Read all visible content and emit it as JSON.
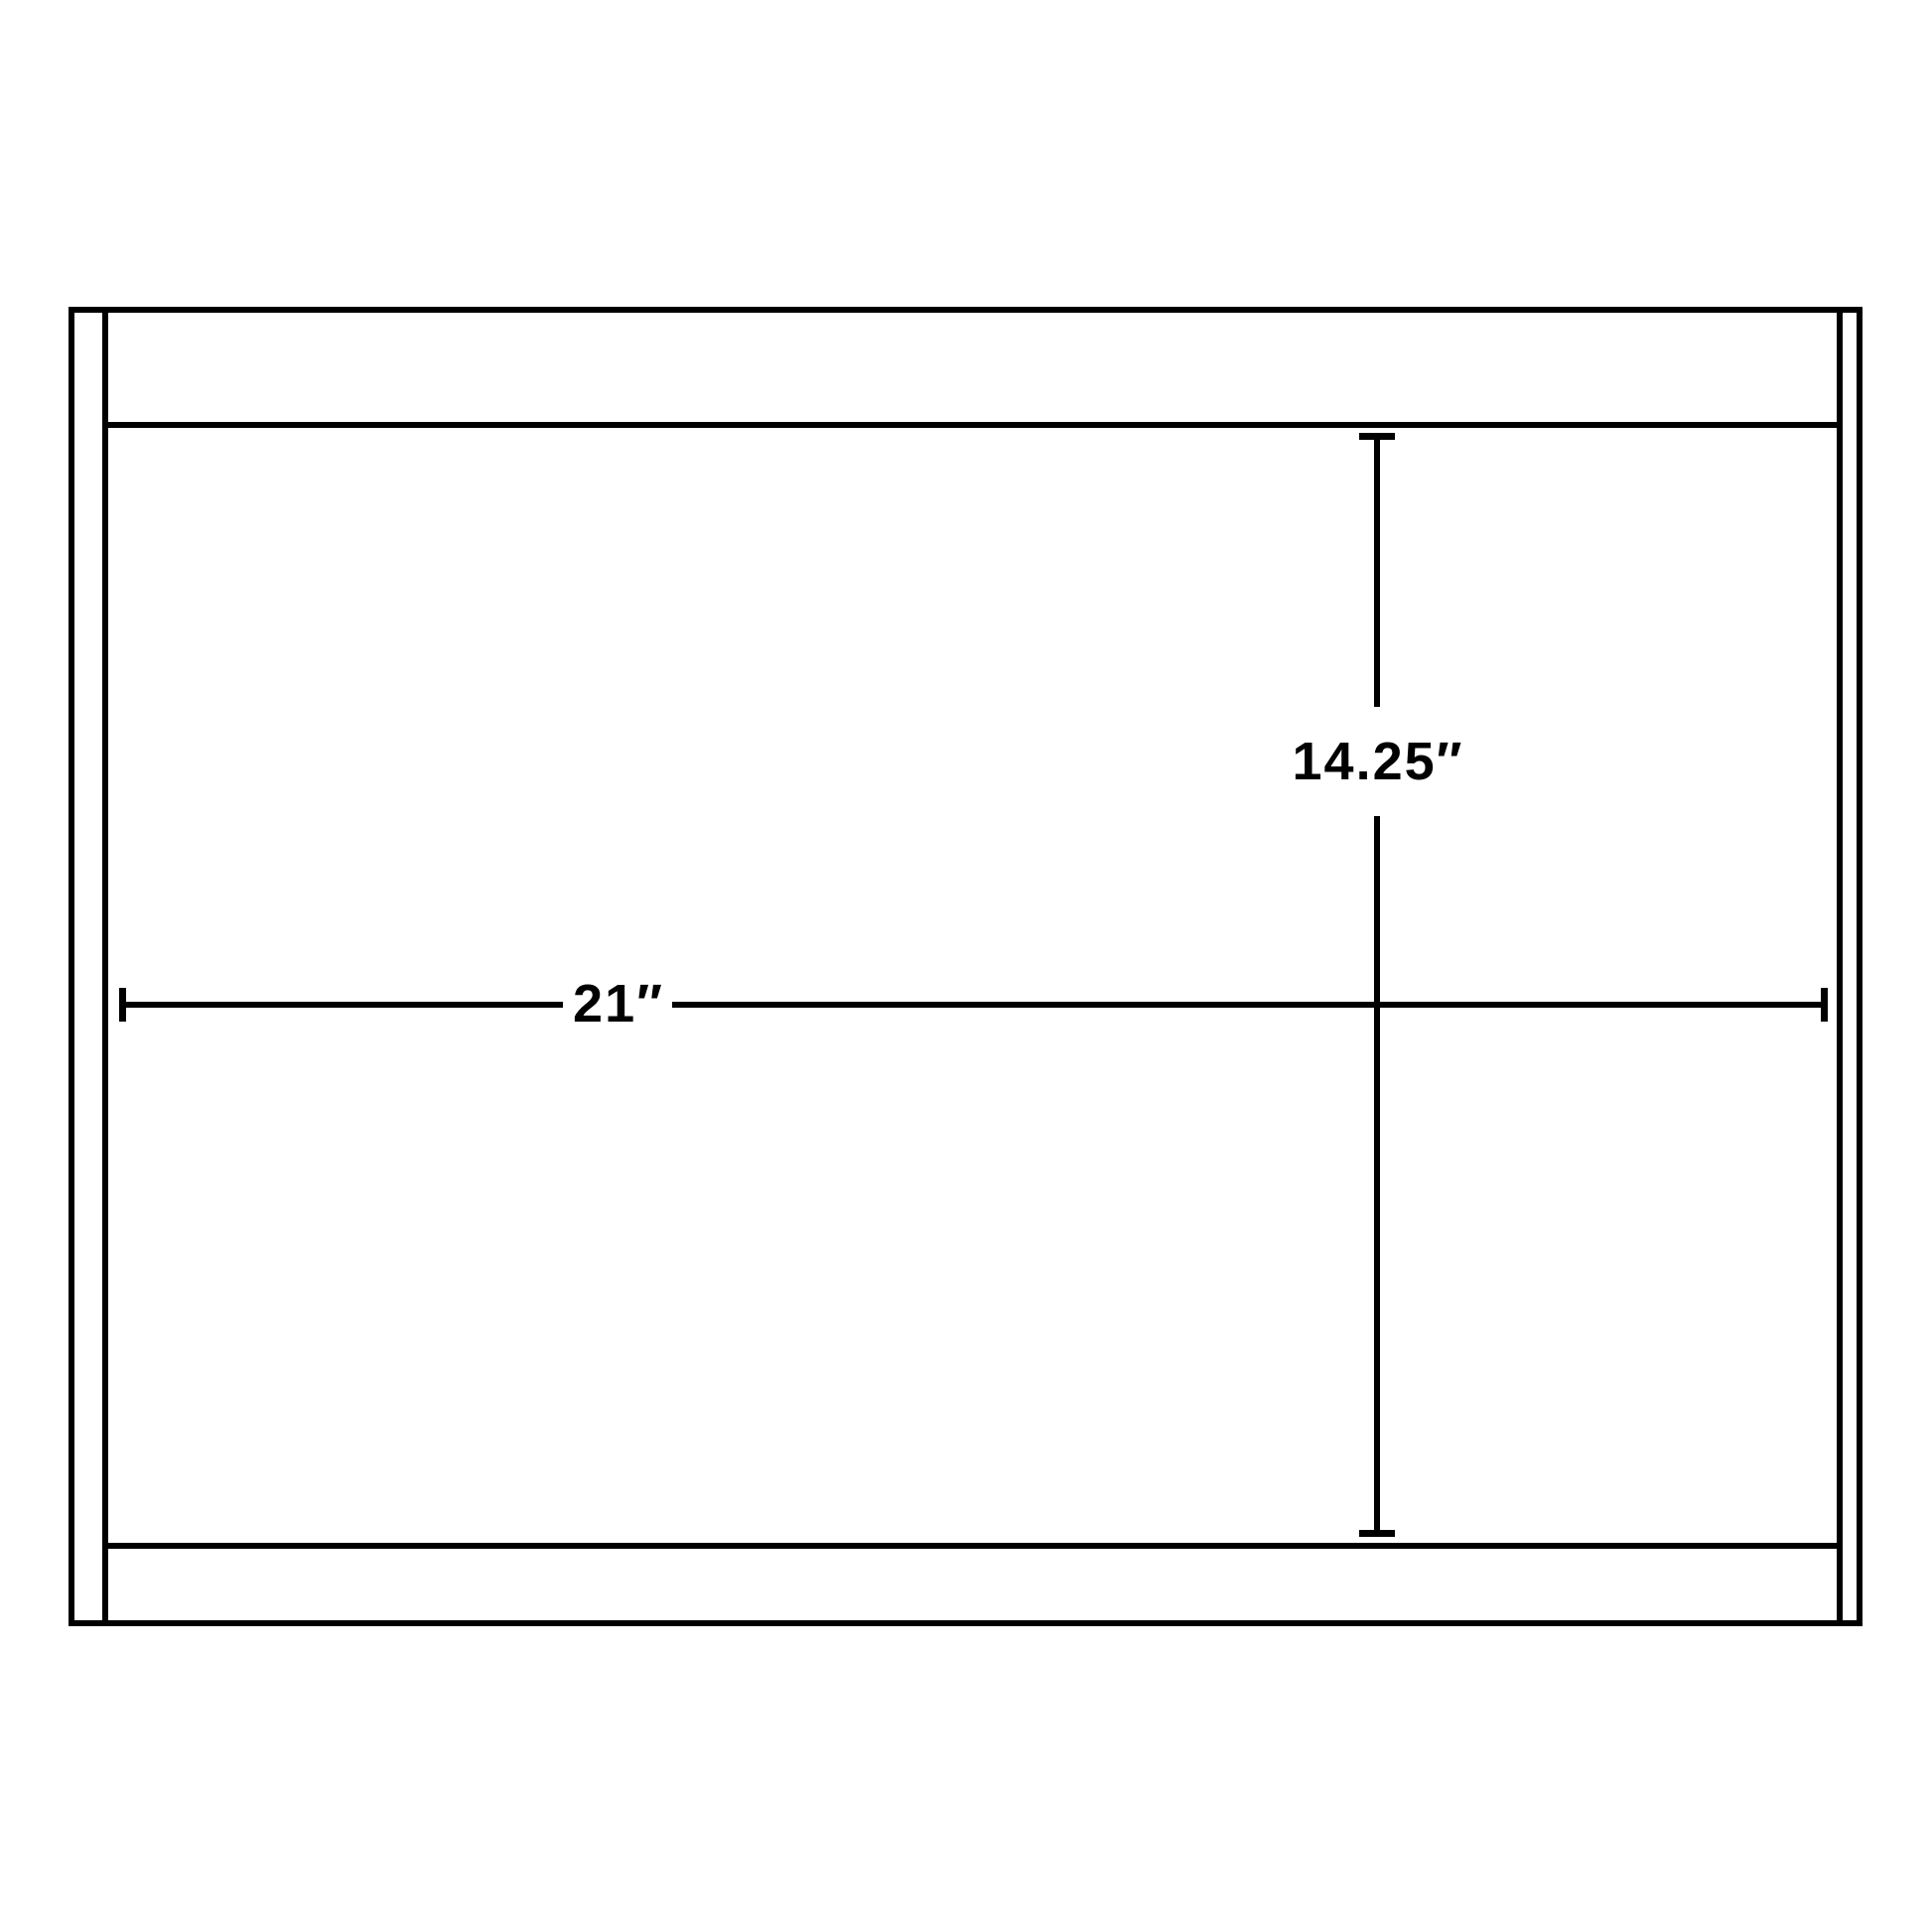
{
  "colors": {
    "background": "#ffffff",
    "line": "#000000",
    "text": "#000000"
  },
  "diagram": {
    "kind": "product-dimension-drawing",
    "object": "rectangular-cabinet-outline",
    "width_dimension": {
      "name": "width",
      "value": 21,
      "unit": "inches",
      "display": "21″",
      "orientation": "horizontal"
    },
    "height_dimension": {
      "name": "depth",
      "value": 14.25,
      "unit": "inches",
      "display": "14.25″",
      "orientation": "vertical"
    }
  }
}
